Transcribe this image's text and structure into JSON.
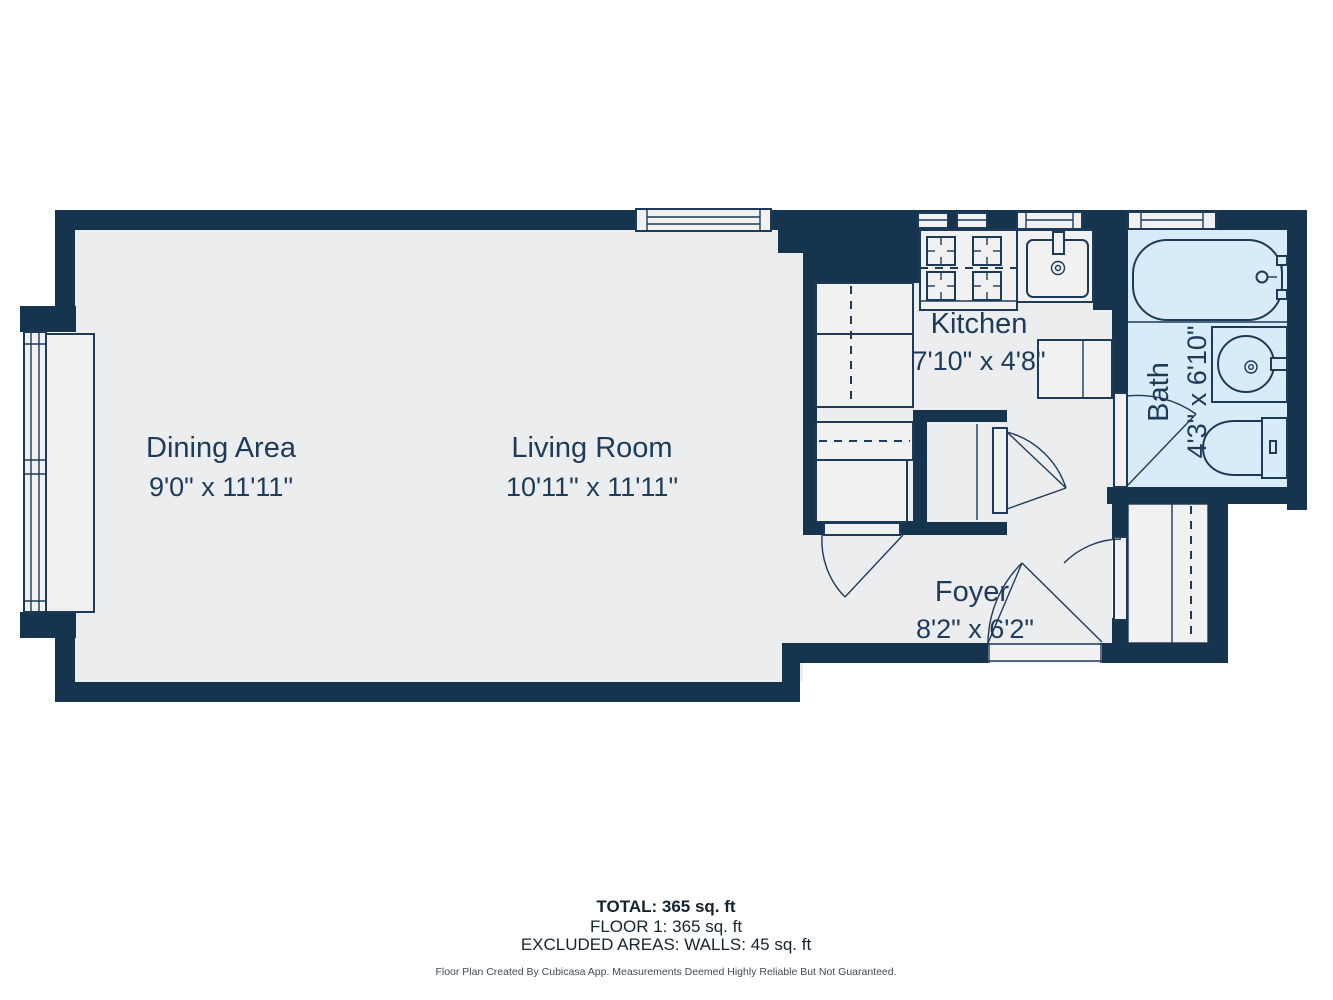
{
  "rooms": {
    "dining": {
      "label": "Dining Area",
      "dims": "9'0\" x 11'11\""
    },
    "living": {
      "label": "Living Room",
      "dims": "10'11\" x 11'11\""
    },
    "kitchen": {
      "label": "Kitchen",
      "dims": "7'10\" x 4'8\""
    },
    "foyer": {
      "label": "Foyer",
      "dims": "8'2\" x 6'2\""
    },
    "bath": {
      "label": "Bath",
      "dims": "4'3\" x 6'10\""
    }
  },
  "summary": {
    "total": "TOTAL: 365 sq. ft",
    "floor1": "FLOOR 1: 365 sq. ft",
    "excluded": "EXCLUDED AREAS: WALLS: 45 sq. ft"
  },
  "disclaimer": "Floor Plan Created By Cubicasa App. Measurements Deemed Highly Reliable But Not Guaranteed.",
  "colors": {
    "wall": "#17344E",
    "floor": "#ECEDEE",
    "bath_floor": "#D7EBF8",
    "fixture_fill": "#F1F1F2",
    "fixture_line": "#1D3B58",
    "room_text": "#1E3C5A",
    "summary_text": "#14242F",
    "disclaimer_text": "#3D4D5A",
    "background": "#FFFFFF"
  },
  "fixture_icons": [
    "bathtub",
    "bath-sink",
    "toilet",
    "kitchen-sink",
    "stove-burners",
    "counter-cabinet",
    "wardrobe-closet",
    "window",
    "door-swing",
    "window-seat"
  ]
}
